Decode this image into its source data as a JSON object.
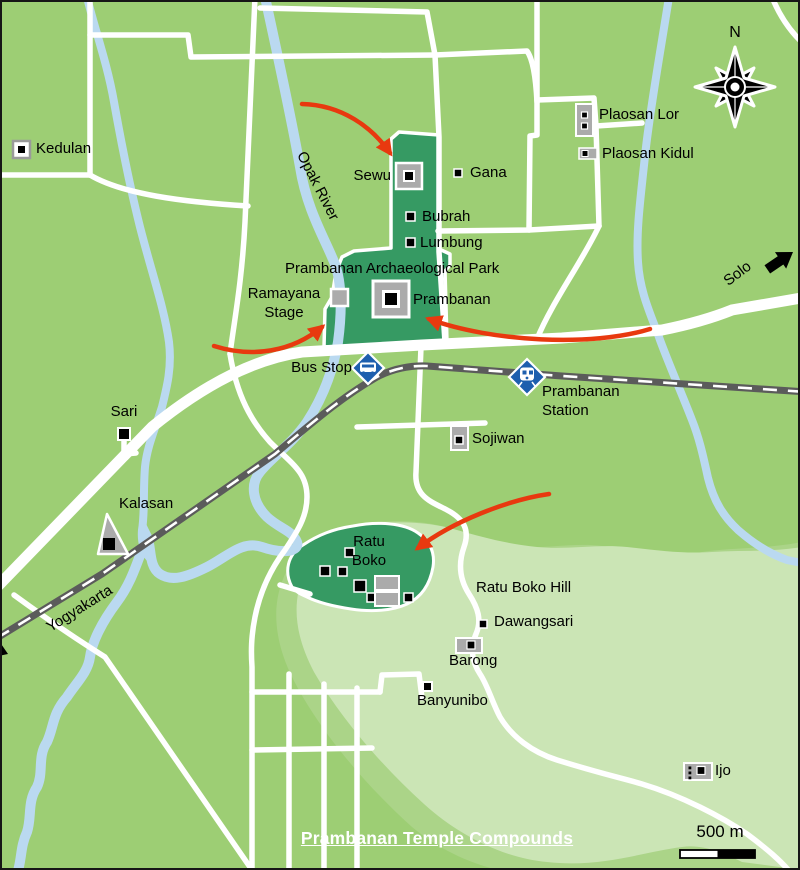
{
  "title": "Prambanan Temple Compounds",
  "compass_n": "N",
  "scale_label": "500 m",
  "areas": {
    "park": "Prambanan Archaeological Park",
    "hill": "Ratu Boko Hill"
  },
  "river": "Opak River",
  "roads": {
    "solo": "Solo",
    "yogyakarta": "Yogyakarta"
  },
  "transit": {
    "bus_stop": "Bus Stop",
    "station": "Prambanan Station"
  },
  "sites": {
    "kedulan": "Kedulan",
    "plaosan_lor": "Plaosan Lor",
    "plaosan_kidul": "Plaosan Kidul",
    "sewu": "Sewu",
    "gana": "Gana",
    "bubrah": "Bubrah",
    "lumbung": "Lumbung",
    "ramayana_stage": "Ramayana Stage",
    "prambanan": "Prambanan",
    "sojiwan": "Sojiwan",
    "sari": "Sari",
    "kalasan": "Kalasan",
    "ratu_boko": "Ratu Boko",
    "dawangsari": "Dawangsari",
    "barong": "Barong",
    "banyunibo": "Banyunibo",
    "ijo": "Ijo"
  },
  "colors": {
    "background": "#9DCE74",
    "park_green": "#369A63",
    "hill_pale": "#CBE5B5",
    "hill_mid": "#ABD488",
    "river_blue": "#BAD9F0",
    "road_white": "#FFFFFF",
    "railway_gray": "#5B5B5B",
    "arrow_red": "#E8390F",
    "sign_blue": "#1E5FAE",
    "icon_gray": "#ABABAB"
  }
}
